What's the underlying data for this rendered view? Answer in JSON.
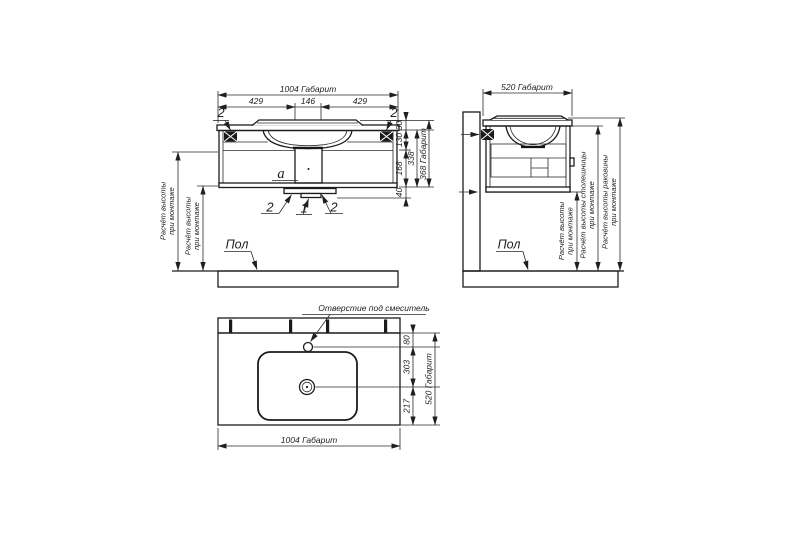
{
  "colors": {
    "line": "#1f1f1f",
    "background": "#ffffff"
  },
  "callouts": {
    "two": "2",
    "one": "1",
    "siphon": "a"
  },
  "labels": {
    "floor": "Пол",
    "faucet_hole": "Отверстие под смеситель",
    "mount_line1": "Расчёт высоты",
    "mount_line2": "при монтаже",
    "countertop_line1": "Расчёт высоты столешницы",
    "sink_line1": "Расчёт высоты раковины"
  },
  "front_view": {
    "dim_total_width": "1004 Габарит",
    "dim_left": "429",
    "dim_center": "146",
    "dim_right": "429",
    "dim_rim": "30",
    "dim_drawer_top": "130",
    "dim_drawer_bottom": "168",
    "dim_body": "338",
    "dim_total_height": "368 Габарит",
    "dim_plinth": "40"
  },
  "side_view": {
    "dim_total_depth": "520 Габарит"
  },
  "top_view": {
    "dim_total_width": "1004 Габарит",
    "dim_total_depth": "520 Габарит",
    "dim_hole_offset": "80",
    "dim_hole_to_drain": "303",
    "dim_drain_to_front": "217"
  }
}
